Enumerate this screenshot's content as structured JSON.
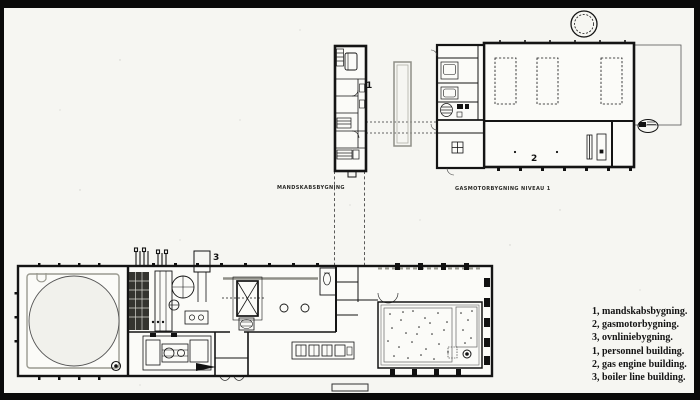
{
  "canvas": {
    "paper_color": "#f6f6f2",
    "frame_color": "#0a0a0a",
    "ink_color": "#1a1a1a",
    "accent_gray": "#8f8f88"
  },
  "plan_labels": {
    "personnel_building_caption": "MANDSKABSBYGNING",
    "gas_engine_building_caption": "GASMOTORBYGNING NIVEAU 1",
    "marker_personnel": "1",
    "marker_gas_engine": "2",
    "marker_boiler_line": "3"
  },
  "legend": {
    "lines": [
      "1, mandskabsbygning.",
      "2, gasmotorbygning.",
      "3, ovnliniebygning.",
      "1, personnel building.",
      "2, gas engine building.",
      "3, boiler line building."
    ]
  }
}
